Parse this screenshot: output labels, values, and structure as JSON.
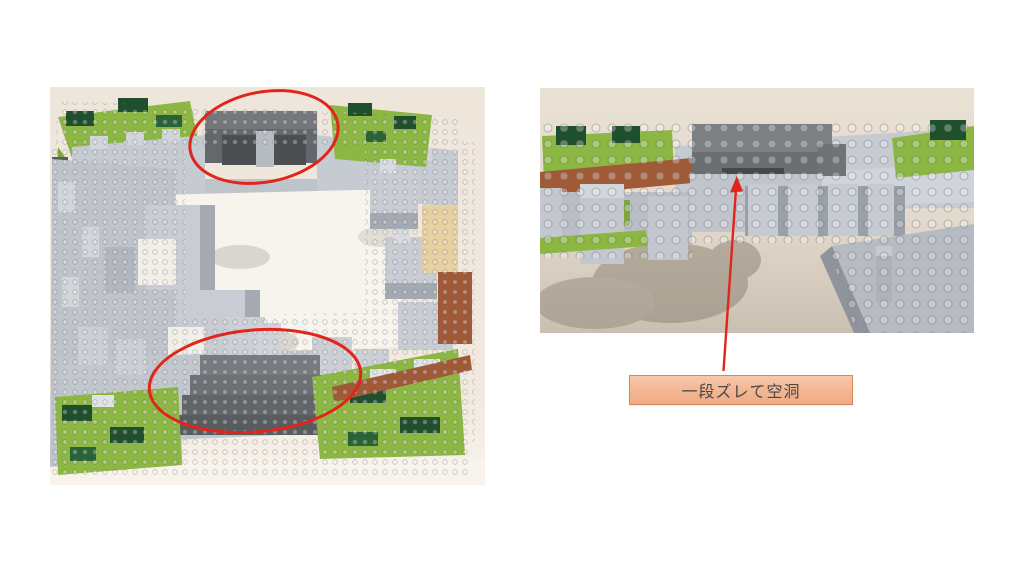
{
  "slide": {
    "background_color": "#ffffff"
  },
  "photos": {
    "overview": {
      "table_color": "#efe6db"
    },
    "closeup": {
      "table_color": "#eae1d5"
    }
  },
  "brick_palette": {
    "light_gray": "#c6cbd2",
    "dark_gray": "#6e7175",
    "lime_green": "#8cb742",
    "dark_green": "#1f4f2c",
    "rust_brown": "#a05a38",
    "tan": "#e7d1a2",
    "courtyard_white": "#f7f4ee"
  },
  "annotations": {
    "color": "#e1251b",
    "callout": {
      "text": "一段ズレて空洞",
      "text_color": "#474747",
      "border_color": "#d6875c",
      "fill_top": "#f8c7ac",
      "fill_bottom": "#f0ac86"
    }
  }
}
